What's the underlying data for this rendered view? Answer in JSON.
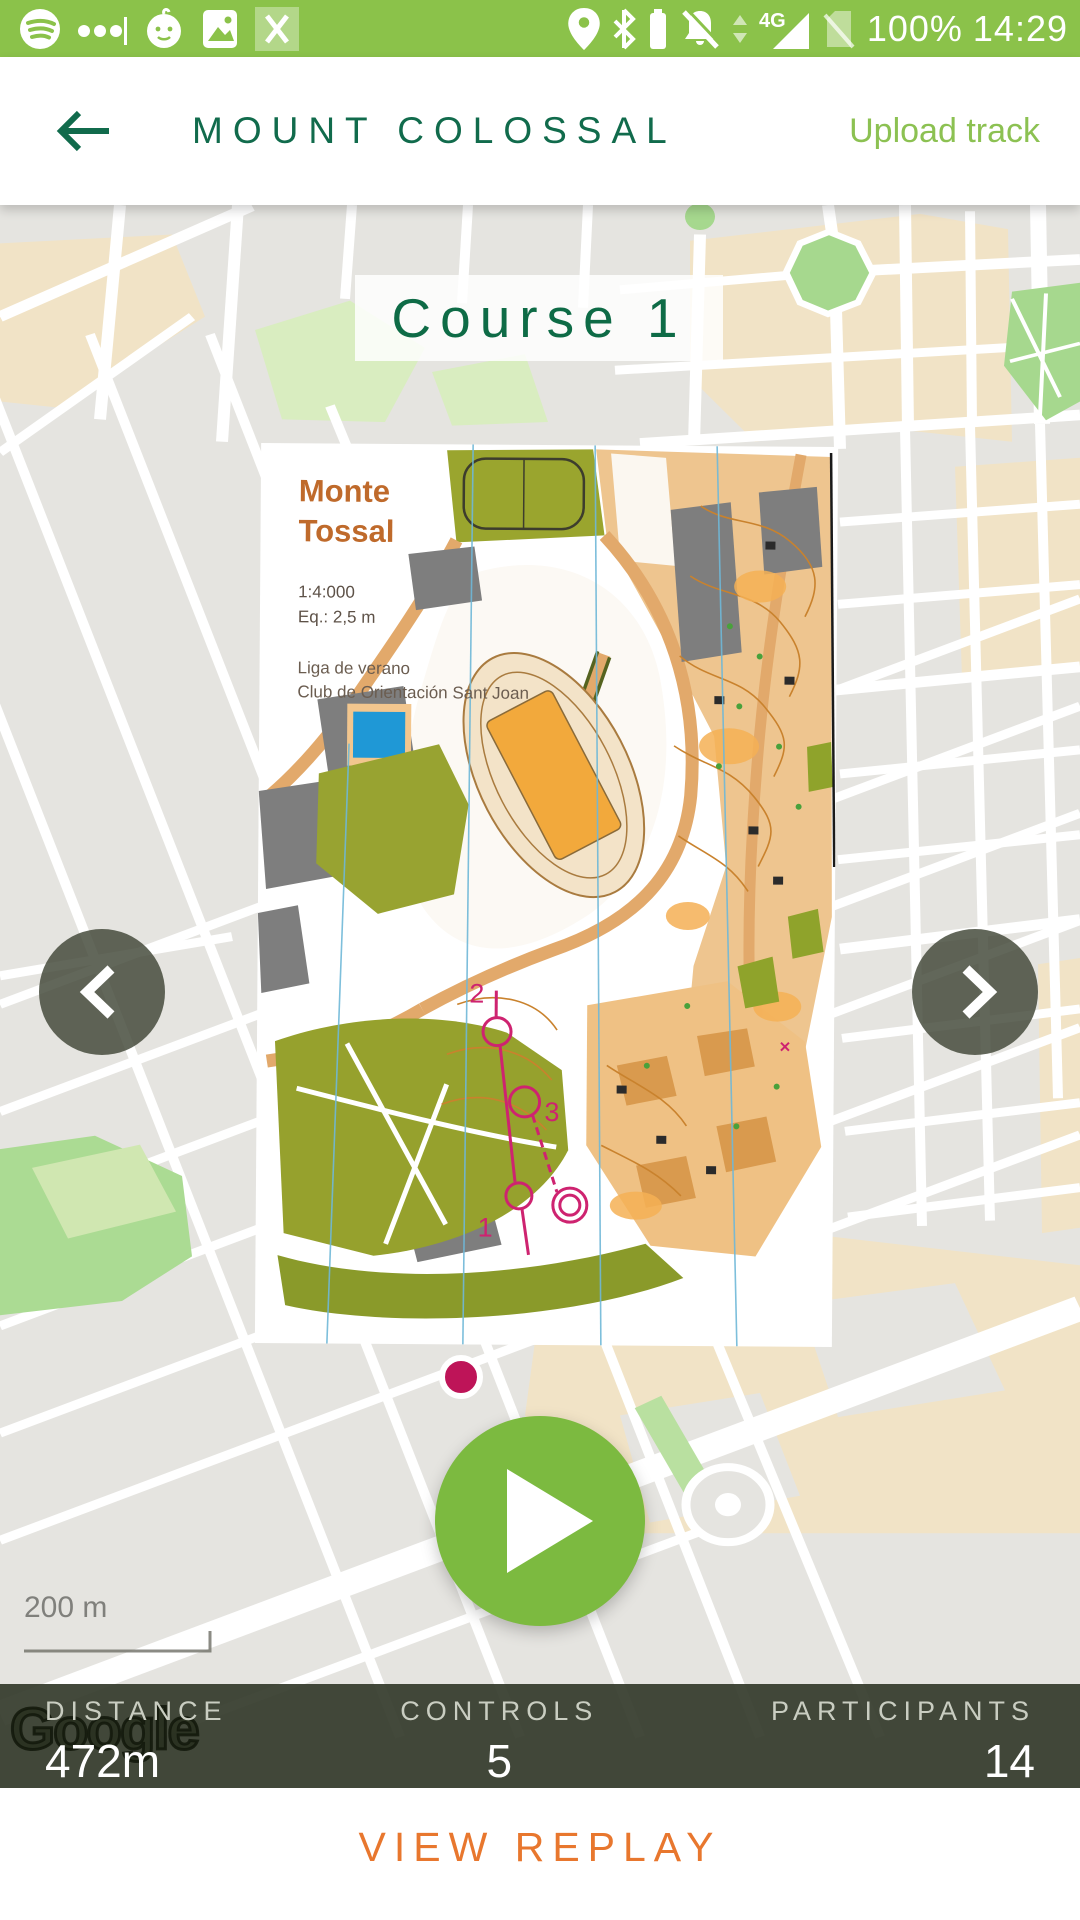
{
  "colors": {
    "status_bar_green": "#8BC24A",
    "header_green": "#116B4C",
    "accent_light_green": "#8CC152",
    "play_green": "#7CBA40",
    "course_magenta": "#CE2370",
    "start_dot_magenta": "#BE1458",
    "stats_bar_olive": "#353B2C",
    "replay_orange": "#E8772E",
    "omap_title_orange": "#BF6A2B",
    "map_background_gray": "#E5E4E0",
    "map_beige": "#F1E3C6",
    "map_park_green": "#A6D88E"
  },
  "status_bar": {
    "battery_level": "100%",
    "time": "14:29",
    "network": "4G",
    "icons_left": [
      "spotify-icon",
      "notification-dots-icon",
      "baby-icon",
      "photo-icon",
      "close-icon"
    ],
    "icons_right": [
      "location-icon",
      "bluetooth-icon",
      "battery-icon",
      "bell-muted-icon",
      "data-arrows-icon",
      "signal-4g-icon",
      "no-sim-icon"
    ]
  },
  "header": {
    "title": "MOUNT COLOSSAL",
    "action": "Upload track"
  },
  "course": {
    "title": "Course 1"
  },
  "omap": {
    "title_line1": "Monte",
    "title_line2": "Tossal",
    "scale": "1:4:000",
    "equidistance": "Eq.: 2,5 m",
    "org_line1": "Liga de verano",
    "org_line2": "Club de Orientación Sant Joan",
    "controls": [
      "1",
      "2",
      "3"
    ]
  },
  "map": {
    "scale_label": "200 m",
    "watermark": "Google"
  },
  "stats": [
    {
      "label": "DISTANCE",
      "value": "472m"
    },
    {
      "label": "CONTROLS",
      "value": "5"
    },
    {
      "label": "PARTICIPANTS",
      "value": "14"
    }
  ],
  "footer": {
    "action": "VIEW REPLAY"
  }
}
